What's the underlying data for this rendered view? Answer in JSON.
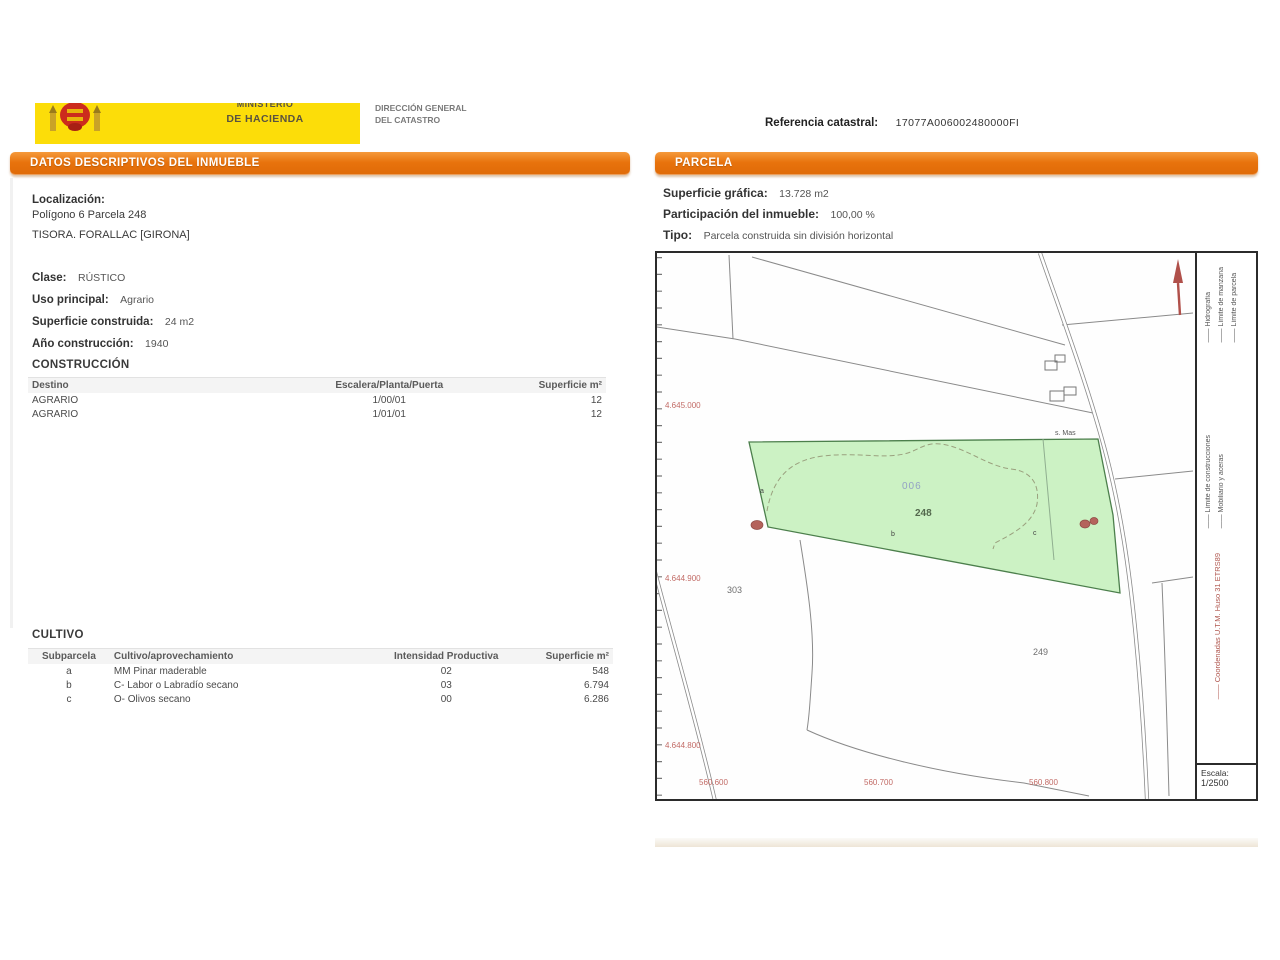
{
  "header": {
    "ministry": {
      "line1": "MINISTERIO",
      "line2": "DE HACIENDA"
    },
    "agency": {
      "line1": "DIRECCIÓN GENERAL",
      "line2": "DEL CATASTRO"
    },
    "ref_label": "Referencia catastral:",
    "ref_value": "17077A006002480000FI"
  },
  "colors": {
    "accent_orange": "#E8730D",
    "banner_yellow": "#FCDD09",
    "parcel_green": "#CCF2C4",
    "map_red": "#B4635C"
  },
  "left_panel": {
    "title": "DATOS DESCRIPTIVOS DEL INMUEBLE",
    "localizacion": {
      "label": "Localización:",
      "line1": "Polígono 6 Parcela 248",
      "line2": "TISORA. FORALLAC [GIRONA]"
    },
    "fields": [
      {
        "label": "Clase:",
        "value": "RÚSTICO"
      },
      {
        "label": "Uso principal:",
        "value": "Agrario"
      },
      {
        "label": "Superficie construida:",
        "value": "24 m2"
      },
      {
        "label": "Año construcción:",
        "value": "1940"
      }
    ],
    "construccion": {
      "title": "CONSTRUCCIÓN",
      "headers": [
        "Destino",
        "Escalera/Planta/Puerta",
        "Superficie m²"
      ],
      "rows": [
        [
          "AGRARIO",
          "1/00/01",
          "12"
        ],
        [
          "AGRARIO",
          "1/01/01",
          "12"
        ]
      ]
    },
    "cultivo": {
      "title": "CULTIVO",
      "headers": [
        "Subparcela",
        "Cultivo/aprovechamiento",
        "Intensidad Productiva",
        "Superficie m²"
      ],
      "rows": [
        [
          "a",
          "MM Pinar maderable",
          "02",
          "548"
        ],
        [
          "b",
          "C- Labor o Labradío secano",
          "03",
          "6.794"
        ],
        [
          "c",
          "O- Olivos secano",
          "00",
          "6.286"
        ]
      ]
    }
  },
  "right_panel": {
    "title": "PARCELA",
    "fields": [
      {
        "label": "Superficie gráfica:",
        "value": "13.728 m2"
      },
      {
        "label": "Participación del inmueble:",
        "value": "100,00 %"
      },
      {
        "label": "Tipo:",
        "value": "Parcela construida sin división horizontal"
      }
    ],
    "map": {
      "parcel_number": "248",
      "subparcel_polygon": "006",
      "neighbor_parcel_left": "303",
      "neighbor_parcel_bottom": "249",
      "subparcel_letters": [
        "a",
        "b",
        "c"
      ],
      "place_label": "s. Mas",
      "y_coords": [
        "4.645.000",
        "4.644.900",
        "4.644.800"
      ],
      "x_coords": [
        "560.600",
        "560.700",
        "560.800"
      ],
      "legend": {
        "items": [
          "Hidrografía",
          "Límite de manzana",
          "Límite de parcela",
          "Límite de construcciones",
          "Mobiliario y aceras"
        ],
        "red_note": "Coordenadas U.T.M. Huso 31 ETRS89"
      },
      "scale_label": "Escala:",
      "scale_value": "1/2500"
    }
  }
}
